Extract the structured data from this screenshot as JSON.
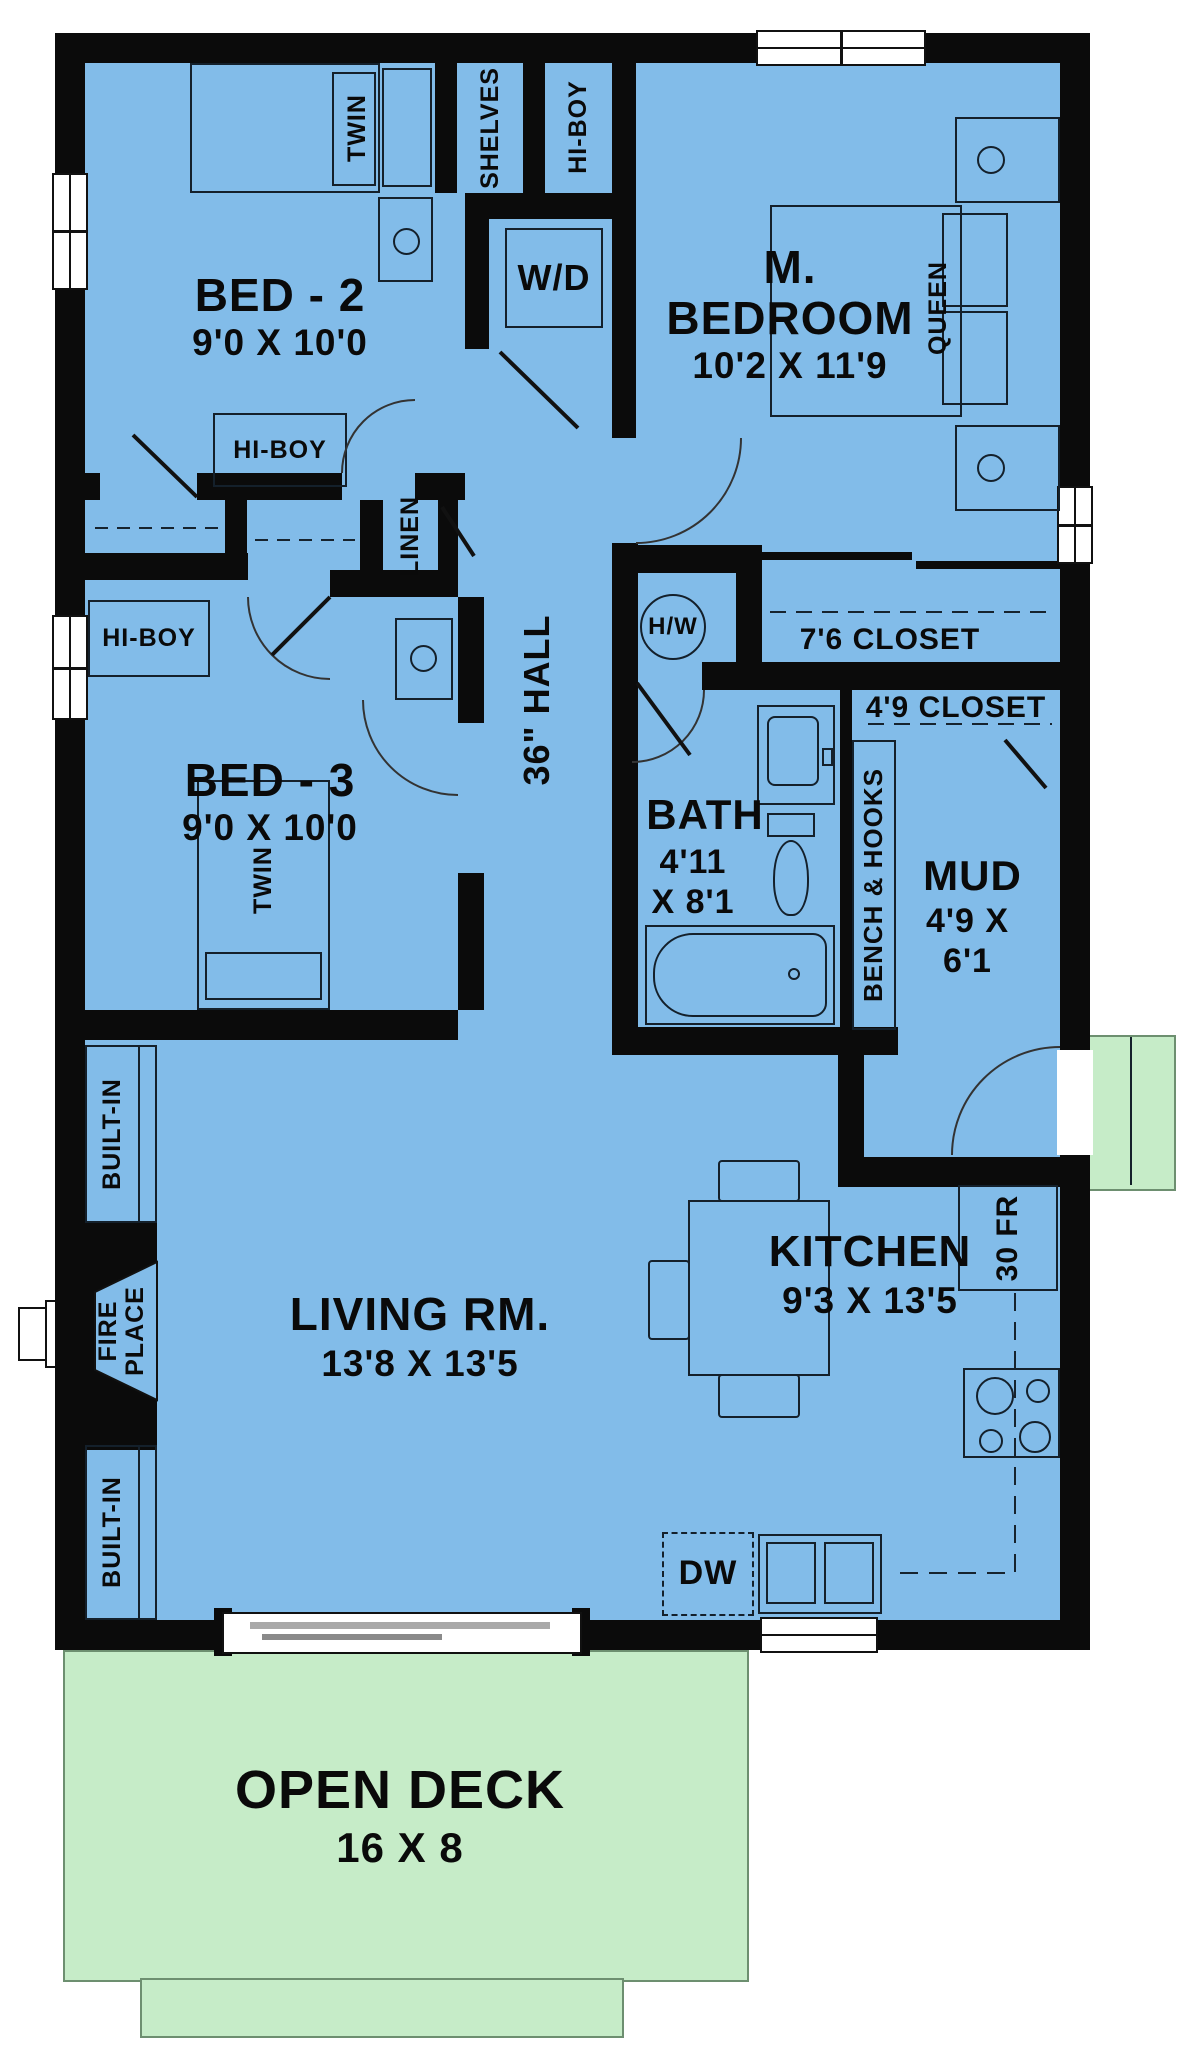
{
  "plan": {
    "colors": {
      "interior": "#82BCE9",
      "deck_green": "#C6ECC8",
      "wall": "#0B0B0B",
      "background": "#FFFFFF"
    },
    "rooms": {
      "bed2": {
        "name": "BED - 2",
        "dims": "9'0 X 10'0"
      },
      "master": {
        "line1": "M.",
        "line2": "BEDROOM",
        "dims": "10'2 X 11'9"
      },
      "bed3": {
        "name": "BED - 3",
        "dims": "9'0 X 10'0"
      },
      "bath": {
        "name": "BATH",
        "dims1": "4'11",
        "dims2": "X 8'1"
      },
      "mud": {
        "name": "MUD",
        "dims1": "4'9 X",
        "dims2": "6'1"
      },
      "living": {
        "name": "LIVING RM.",
        "dims": "13'8 X 13'5"
      },
      "kitchen": {
        "name": "KITCHEN",
        "dims": "9'3 X 13'5"
      },
      "hall": {
        "name": "36\" HALL"
      },
      "deck": {
        "name": "OPEN DECK",
        "dims": "16 X 8"
      }
    },
    "labels": {
      "twin_bed2": "TWIN",
      "twin_bed3": "TWIN",
      "queen": "QUEEN",
      "shelves": "SHELVES",
      "hiboy_closet": "HI-BOY",
      "hiboy_bed2": "HI-BOY",
      "hiboy_bed3": "HI-BOY",
      "wd": "W/D",
      "linen": "LINEN",
      "hw": "H/W",
      "closet76": "7'6 CLOSET",
      "closet49": "4'9 CLOSET",
      "bench": "BENCH & HOOKS",
      "fire1": "FIRE",
      "fire2": "PLACE",
      "builtin_upper": "BUILT-IN",
      "builtin_lower": "BUILT-IN",
      "fridge": "30 FR",
      "dw": "DW"
    }
  }
}
